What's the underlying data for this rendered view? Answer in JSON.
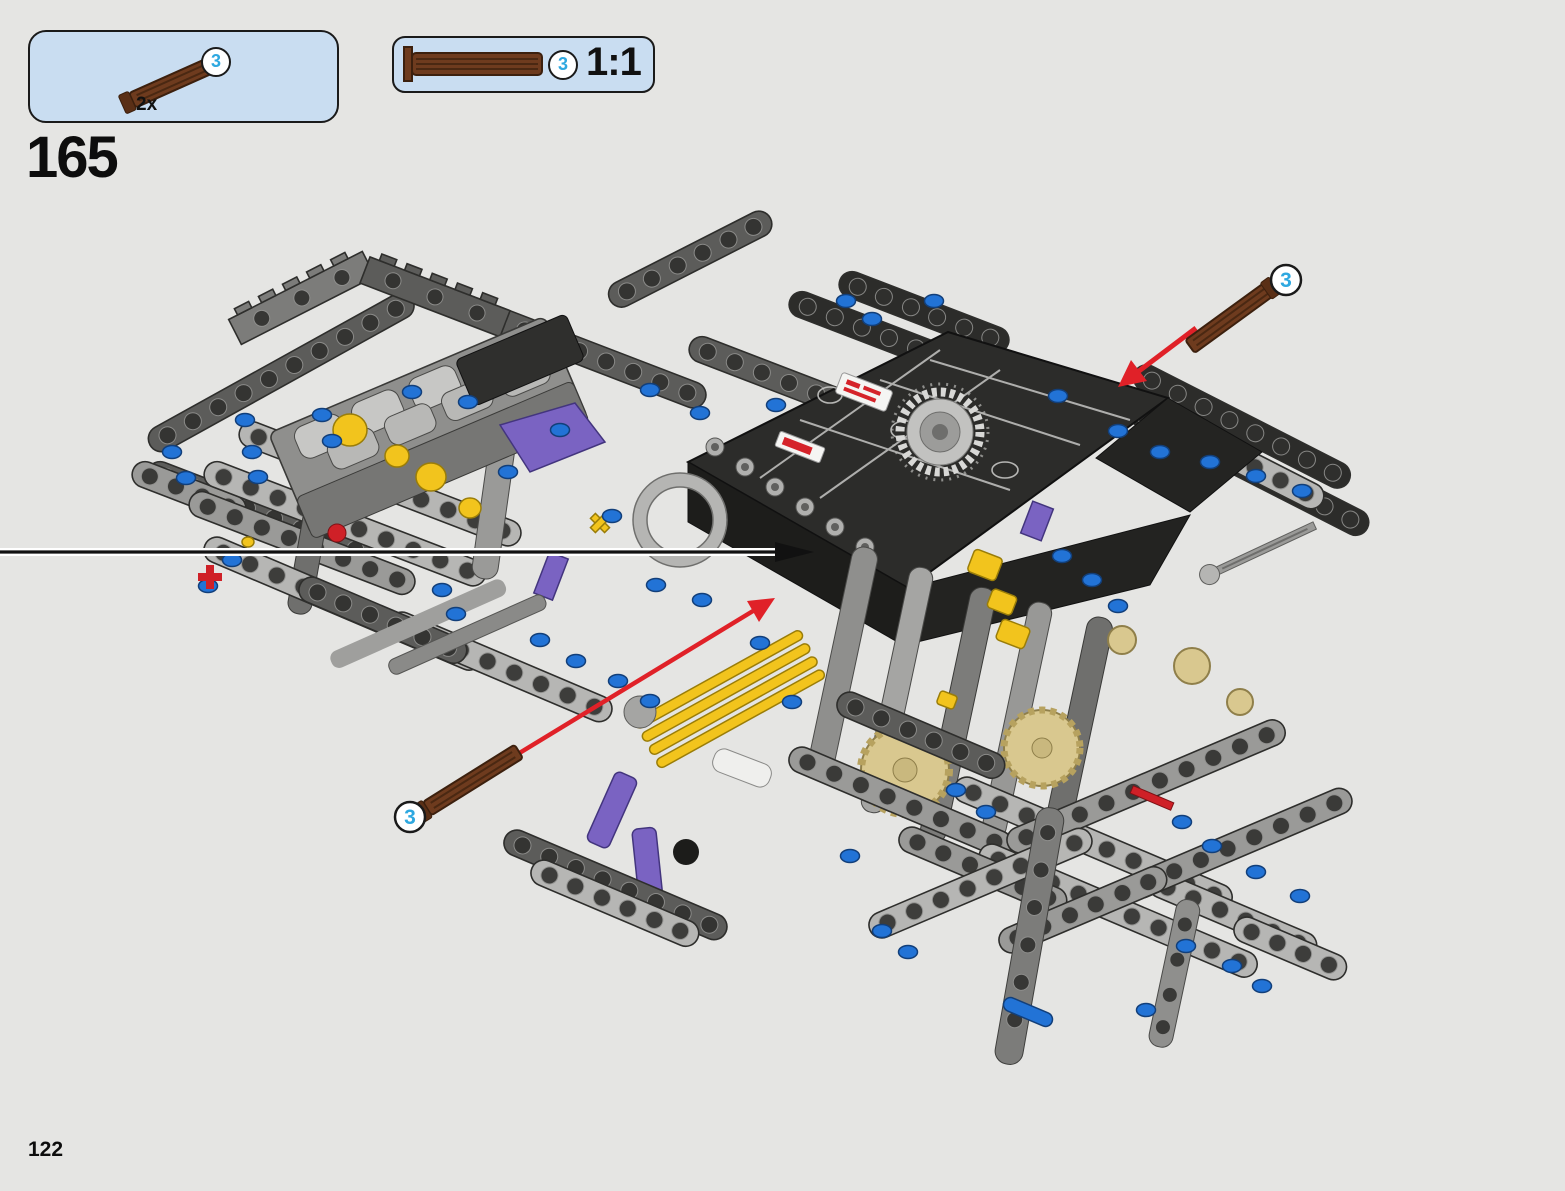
{
  "page": {
    "number": "122"
  },
  "step": {
    "number": "165"
  },
  "parts_callout": {
    "part_number": "3",
    "quantity_label": "2x",
    "part_icon": "brown-axle-3l-with-stop-icon"
  },
  "scale_box": {
    "part_number": "3",
    "scale_label": "1:1",
    "part_icon": "brown-axle-3l-with-stop-icon-actual-size"
  },
  "diagram": {
    "description": "Isometric LEGO Technic chassis assembly: gray V8 engine block with yellow cams and purple intake wedge at left, large black body panel with silver chain sprocket and red-white stickers at center, yellow gearbox parts and tan gears below, light-gray beam lattice extending right and down; two brown stop-axles being inserted along red arrows; black leader line entering from left page edge",
    "callouts": [
      {
        "part_number": "3",
        "position": "upper-right"
      },
      {
        "part_number": "3",
        "position": "lower-left"
      }
    ],
    "stickers": [
      "white-red-logo-sticker",
      "red-logo-sticker"
    ],
    "colors": {
      "background": "#e5e5e3",
      "callout_box_fill": "#c9ddf1",
      "badge_number_blue": "#2ea8e0",
      "axle_brown": "#6e3b1e",
      "arrow_red": "#e02128",
      "leader_black": "#111111",
      "beam_light_gray": "#b6b6b4",
      "beam_dark": "#2c2c2a",
      "gear_tan": "#d9c88f",
      "accent_yellow": "#f2c41d",
      "accent_purple": "#7a63c2",
      "pin_blue": "#2273d6"
    }
  }
}
